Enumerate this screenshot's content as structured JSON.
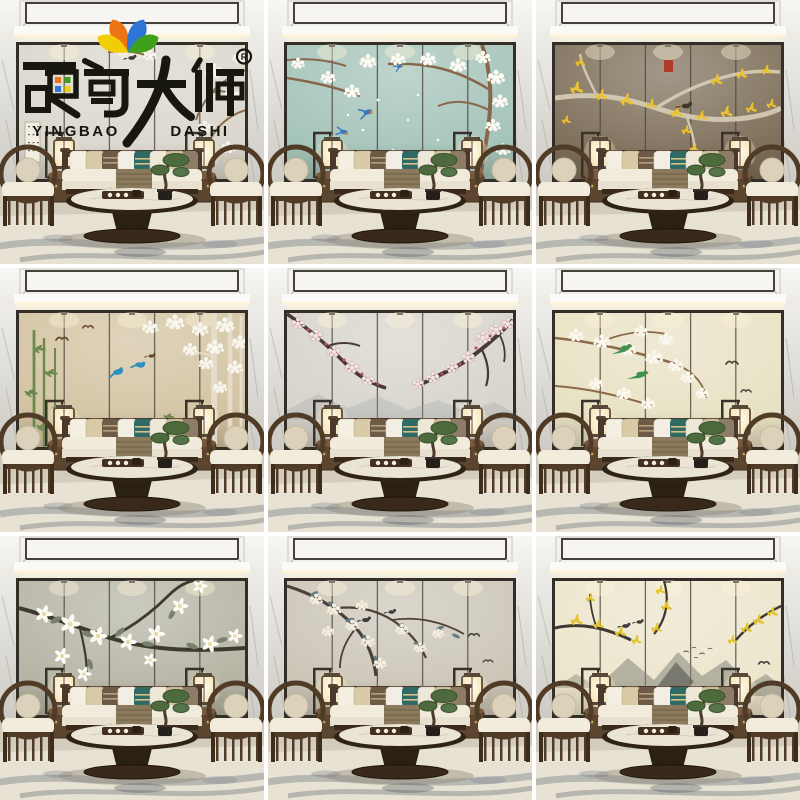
{
  "page": {
    "kind": "e-commerce product image collage",
    "grid": "3x3",
    "subject": "Chinese-style living room hard-pack wall panel (chinoiserie flower-and-bird murals) shown in nine colorways, same staged room in every tile"
  },
  "brand": {
    "cn": "硬包大师",
    "latin_left": "YINGBAO",
    "latin_right": "DASHI",
    "registered_mark": "R",
    "ink": "#17160f",
    "petals": {
      "orange": "#ed7414",
      "blue": "#2e76d6",
      "yellow": "#f0cd04",
      "green": "#3ea01b"
    }
  },
  "room": {
    "wood": "#4b382a",
    "sofa_fabric": "#f1ebdc",
    "accent_pillow": "#2f6b64",
    "lamp_glow": "#fdf3d8",
    "rug_ink": "#45506b"
  },
  "tiles": [
    {
      "id": "brand-cover-grey-magnolia",
      "alt": "Brand logo over pale grey panels with magnolia sprays and calligraphy scroll",
      "has_logo": true,
      "art": 1,
      "palette": {
        "wall": "#dad6cc",
        "branch": "#8a6b4c",
        "bloom": "#f7f4ec",
        "accent": "#3c3b37",
        "extra": "#8e897c"
      }
    },
    {
      "id": "teal-plum-blossom-swallows",
      "alt": "Teal wall, white plum blossom tree with blue-orange swallows",
      "has_logo": false,
      "art": 2,
      "palette": {
        "wall": "#a3c3b8",
        "branch": "#87664a",
        "bloom": "#fcfaf3",
        "accent": "#3a79c0",
        "extra": "#d97b2e"
      }
    },
    {
      "id": "taupe-golden-ginkgo",
      "alt": "Dark taupe wall, silver branch with golden ginkgo leaves, bird and red seal",
      "has_logo": false,
      "art": 3,
      "palette": {
        "wall": "#7c6d57",
        "branch": "#d5cab4",
        "bloom": "#ecc22f",
        "accent": "#b23a28",
        "extra": "#43362a"
      }
    },
    {
      "id": "beige-bamboo-birch-birds",
      "alt": "Beige wall, green bamboo, white birch and blossom canopy, kingfisher-blue birds",
      "has_logo": false,
      "art": 4,
      "palette": {
        "wall": "#d2c2a0",
        "branch": "#e6dfcd",
        "bloom": "#f8f5ec",
        "accent": "#2f8fbf",
        "extra": "#6d8a4e"
      }
    },
    {
      "id": "grey-red-plum",
      "alt": "Light grey wall, gnarled plum branches with pink-red blossoms and faint hills",
      "has_logo": false,
      "art": 5,
      "palette": {
        "wall": "#d6d3ca",
        "branch": "#473a30",
        "bloom": "#f3e6e2",
        "accent": "#c24f5e",
        "extra": "#9aa3ab"
      }
    },
    {
      "id": "cream-blossom-green-parrots",
      "alt": "Pale yellow wall, white blossoms with long-tailed green birds",
      "has_logo": false,
      "art": 6,
      "palette": {
        "wall": "#e7e1c2",
        "branch": "#8a6a48",
        "bloom": "#fbf7ee",
        "accent": "#3f9350",
        "extra": "#51443a"
      }
    },
    {
      "id": "sage-white-magnolia",
      "alt": "Grey-green wall, large white magnolia flowers on dark branch",
      "has_logo": false,
      "art": 7,
      "palette": {
        "wall": "#b4b3a3",
        "branch": "#3f3a30",
        "bloom": "#fbfaf3",
        "accent": "#78816a",
        "extra": "#d9d2be"
      }
    },
    {
      "id": "warm-grey-chinoiserie-birds",
      "alt": "Warm grey wall, branch with slate-teal leaves, cream blossoms and small birds",
      "has_logo": false,
      "art": 8,
      "palette": {
        "wall": "#cbc5b7",
        "branch": "#4a4038",
        "bloom": "#f3eddc",
        "accent": "#647a80",
        "extra": "#3c3c3a"
      }
    },
    {
      "id": "cream-gold-ink-mountains",
      "alt": "Cream wall, ink-wash mountains with golden sprigs and birds",
      "has_logo": false,
      "art": 9,
      "palette": {
        "wall": "#ece5cb",
        "branch": "#3e3832",
        "bloom": "#e3c32c",
        "accent": "#85857b",
        "extra": "#3a3a36"
      }
    }
  ]
}
